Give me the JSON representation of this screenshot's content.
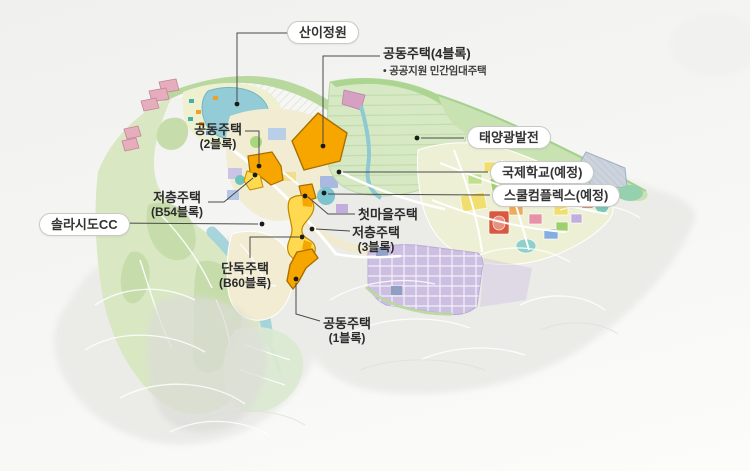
{
  "labels": {
    "sani_garden": {
      "text": "산이정원"
    },
    "apt_block4": {
      "title": "공동주택(4블록)",
      "note": "• 공공지원 민간임대주택"
    },
    "apt_block2": {
      "line1": "공동주택",
      "line2": "(2블록)"
    },
    "solar_power": {
      "text": "태양광발전"
    },
    "intl_school": {
      "text": "국제학교(예정)"
    },
    "school_complex": {
      "text": "스쿨컴플렉스(예정)"
    },
    "lowrise_b54": {
      "line1": "저층주택",
      "line2": "(B54블록)"
    },
    "first_village": {
      "text": "첫마을주택"
    },
    "lowrise_3": {
      "line1": "저층주택",
      "line2": "(3블록)"
    },
    "solasido_cc": {
      "text": "솔라시도CC"
    },
    "detached_b60": {
      "line1": "단독주택",
      "line2": "(B60블록)"
    },
    "apt_block1": {
      "line1": "공동주택",
      "line2": "(1블록)"
    }
  },
  "colors": {
    "highlight_block": "#f7a600",
    "highlight_block_light": "#ffd94f",
    "golf_green": "#d9e7c3",
    "solar_field": "#d7e9c4",
    "garden_pond": "#93ccd6",
    "residential_grid": "#cdbfe2",
    "leader_line": "#4a4a4a",
    "marker_dot": "#1a1a1a"
  }
}
